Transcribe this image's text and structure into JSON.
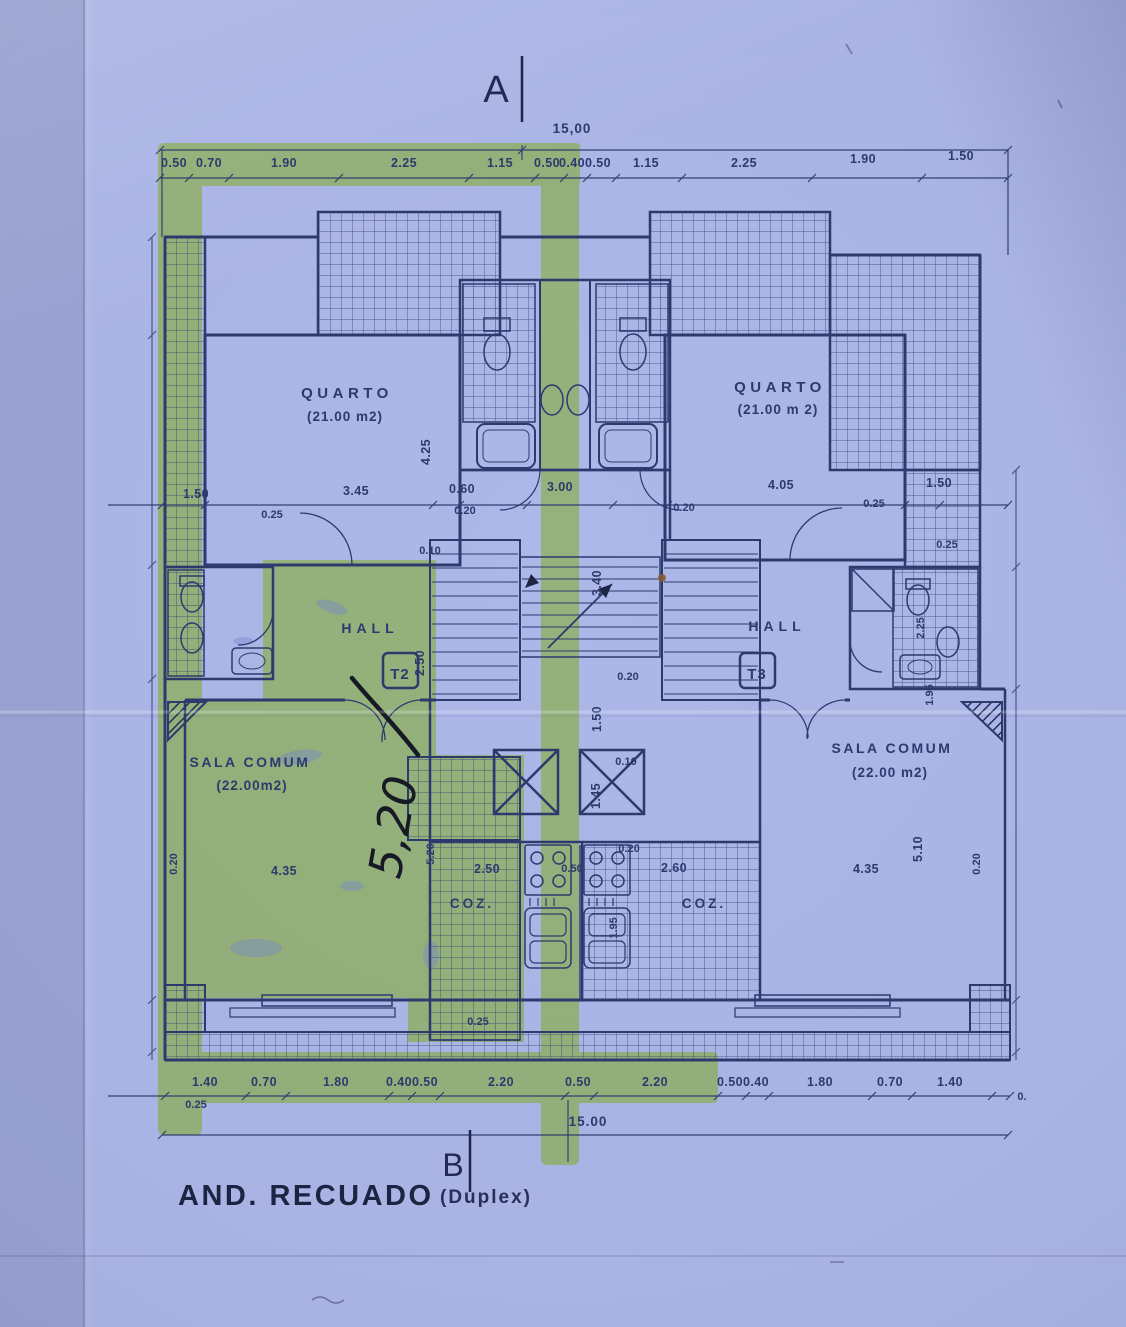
{
  "drawing": {
    "section_top": "A",
    "section_bottom": "B",
    "title": "AND. RECUADO",
    "subtitle": "(Duplex)",
    "overall_top": "15,00",
    "overall_bottom": "15.00"
  },
  "dims_top": [
    "0.50",
    "0.70",
    "1.90",
    "2.25",
    "1.15",
    "0.50",
    "0.40",
    "0.50",
    "1.15",
    "2.25",
    "1.90",
    "1.50"
  ],
  "dims_bottom": [
    "1.40",
    "0.70",
    "1.80",
    "0.40",
    "0.50",
    "2.20",
    "0.50",
    "2.20",
    "0.50",
    "0.40",
    "1.80",
    "0.70",
    "1.40"
  ],
  "dims_bottom_left": "0.25",
  "dims_bottom_right": "0.",
  "dims_mid": [
    "1.50",
    "3.45",
    "0.60",
    "3.00",
    "4.05",
    "1.50"
  ],
  "dims_mid_small": [
    "0.25",
    "0.20",
    "0.20",
    "0.25",
    "0.25",
    "0.10"
  ],
  "dims_inner": {
    "quarto_left_depth": "4.25",
    "core_depth": "3.40",
    "hall_left_depth": "2.50",
    "bath_right_w": "2.25",
    "bath_right_d": "1.95",
    "core_wall": "0.20",
    "corridor": "1.50",
    "lift_gap": "0.10",
    "lift_depth": "1.45",
    "kitchen_wall": "0.20",
    "coz_left_w": "2.50",
    "coz_mid": "0.50",
    "coz_right_w": "2.60",
    "coz_left_d": "5.20",
    "sala_right_d": "5.10",
    "wall_left": "0.20",
    "wall_right": "0.20",
    "sala_left_w": "4.35",
    "sala_right_w": "4.35",
    "sink_run": "1.95",
    "step": "0.25"
  },
  "rooms": {
    "quarto_left": {
      "name": "QUARTO",
      "area": "(21.00 m2)"
    },
    "quarto_right": {
      "name": "QUARTO",
      "area": "(21.00 m 2)"
    },
    "hall_left": {
      "name": "HALL",
      "unit": "T2"
    },
    "hall_right": {
      "name": "HALL",
      "unit": "T3"
    },
    "sala_left": {
      "name": "SALA COMUM",
      "area": "(22.00m2)"
    },
    "sala_right": {
      "name": "SALA COMUM",
      "area": "(22.00 m2)"
    },
    "coz_left": {
      "name": "COZ."
    },
    "coz_right": {
      "name": "COZ."
    }
  },
  "annotations": {
    "handwritten_dim": "5,20"
  },
  "colors": {
    "paper": "#a9b3e3",
    "ink": "#2c3a6e",
    "highlighter": "#c6f23f",
    "pen": "#171a24"
  }
}
